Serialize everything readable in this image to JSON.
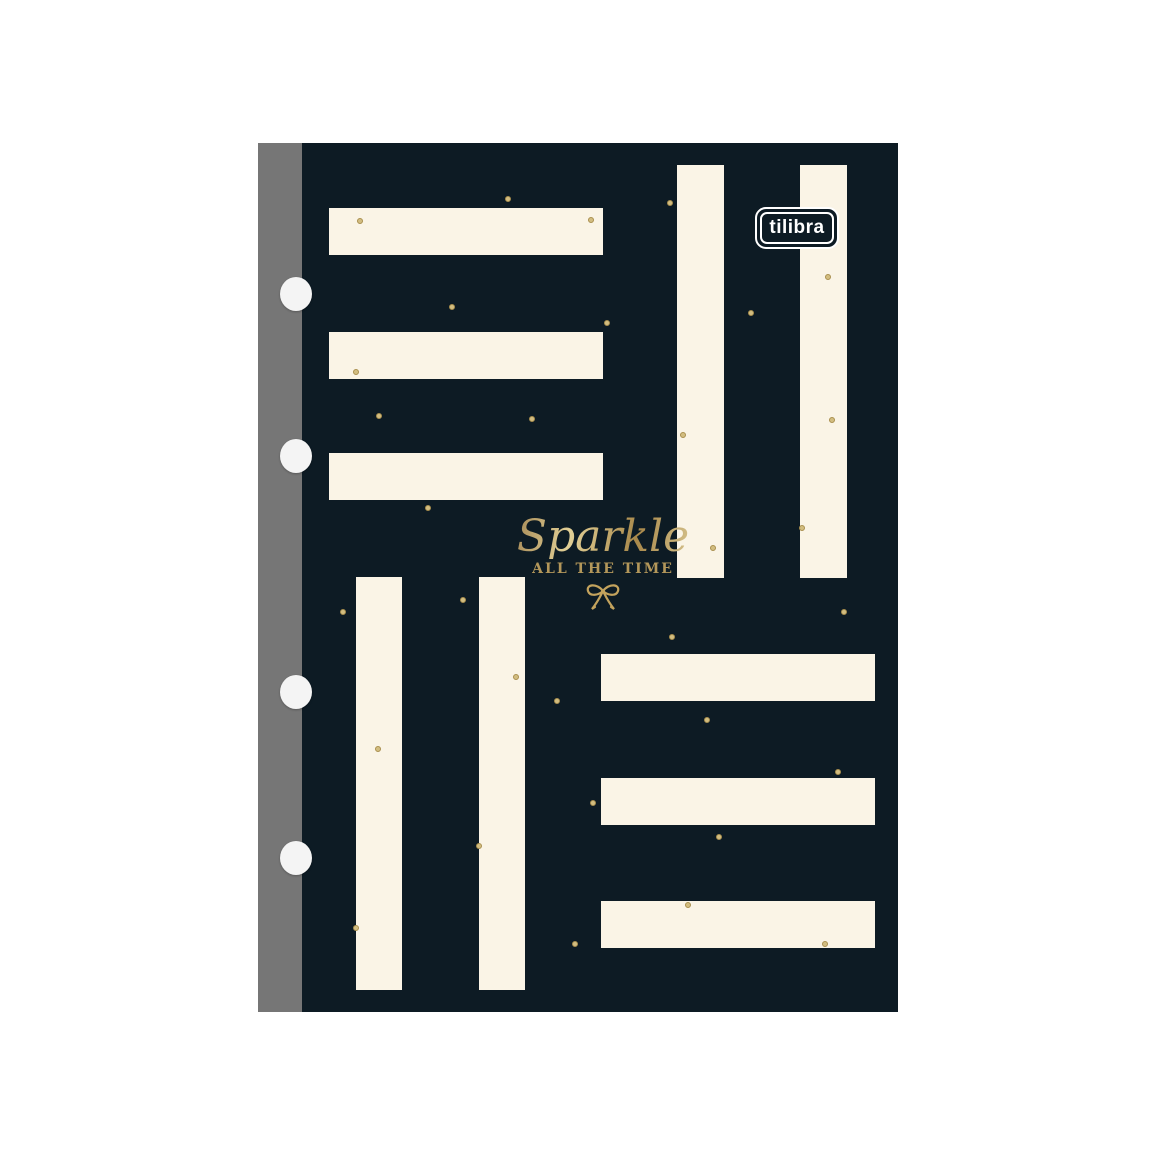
{
  "product": {
    "brand": "tilibra",
    "title": "Sparkle",
    "subtitle": "ALL THE TIME"
  },
  "colors": {
    "page_background": "#ffffff",
    "cover_navy": "#0d1b24",
    "stripe_cream": "#faf4e6",
    "gold_text": "#c9ab62",
    "gold_dot": "#d2bd80",
    "spine_gray": "#767676",
    "hole_white": "#f4f4f4",
    "logo_border_white": "#ffffff"
  },
  "icons": [
    "bow-icon",
    "brand-logo"
  ],
  "pattern": {
    "stripes": [
      {
        "group": "top-left-horizontal",
        "x": 27,
        "y": 65,
        "w": 274,
        "h": 47
      },
      {
        "group": "top-left-horizontal",
        "x": 27,
        "y": 189,
        "w": 274,
        "h": 47
      },
      {
        "group": "top-left-horizontal",
        "x": 27,
        "y": 310,
        "w": 274,
        "h": 47
      },
      {
        "group": "top-right-vertical",
        "x": 375,
        "y": 22,
        "w": 47,
        "h": 413
      },
      {
        "group": "top-right-vertical",
        "x": 498,
        "y": 22,
        "w": 47,
        "h": 413
      },
      {
        "group": "bottom-left-vertical",
        "x": 54,
        "y": 434,
        "w": 46,
        "h": 413
      },
      {
        "group": "bottom-left-vertical",
        "x": 177,
        "y": 434,
        "w": 46,
        "h": 413
      },
      {
        "group": "bottom-right-horizontal",
        "x": 299,
        "y": 511,
        "w": 274,
        "h": 47
      },
      {
        "group": "bottom-right-horizontal",
        "x": 299,
        "y": 635,
        "w": 274,
        "h": 47
      },
      {
        "group": "bottom-right-horizontal",
        "x": 299,
        "y": 758,
        "w": 274,
        "h": 47
      }
    ],
    "dots": [
      [
        206,
        56
      ],
      [
        368,
        60
      ],
      [
        58,
        78
      ],
      [
        289,
        77
      ],
      [
        526,
        134
      ],
      [
        449,
        170
      ],
      [
        150,
        164
      ],
      [
        305,
        180
      ],
      [
        54,
        229
      ],
      [
        77,
        273
      ],
      [
        230,
        276
      ],
      [
        381,
        292
      ],
      [
        530,
        277
      ],
      [
        126,
        365
      ],
      [
        411,
        405
      ],
      [
        500,
        385
      ],
      [
        542,
        469
      ],
      [
        370,
        494
      ],
      [
        41,
        469
      ],
      [
        161,
        457
      ],
      [
        214,
        534
      ],
      [
        255,
        558
      ],
      [
        76,
        606
      ],
      [
        405,
        577
      ],
      [
        536,
        629
      ],
      [
        291,
        660
      ],
      [
        417,
        694
      ],
      [
        177,
        703
      ],
      [
        54,
        785
      ],
      [
        386,
        762
      ],
      [
        523,
        801
      ],
      [
        273,
        801
      ]
    ],
    "holes_cy": [
      151,
      313,
      549,
      715
    ],
    "holes_cx": 38
  }
}
